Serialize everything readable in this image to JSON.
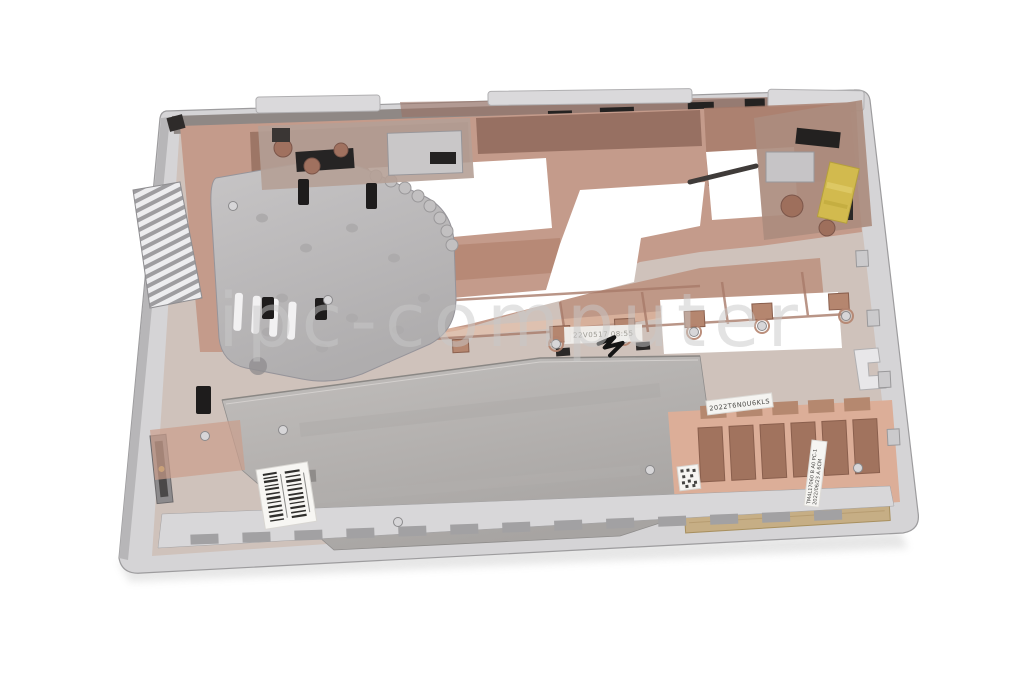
{
  "photo": {
    "subject": "Laptop bottom case (base enclosure), inside view, product photo on white background",
    "background": "#ffffff"
  },
  "watermark": {
    "text": "ipc-computer",
    "color": "#c9c9c9"
  },
  "markings": {
    "qc_stamp": "22V0517 08:55",
    "serial_sticker": "2022T6N0U6KLS",
    "date_label_line1": "TM4L17060 B A0 PC-1",
    "date_label_line2": "2022/06/23 A 6CM"
  },
  "colors": {
    "rim_silver": "#d5d4d6",
    "copper_coating": "#c49b8b",
    "copper_dark": "#8b655a",
    "shield_plate": "#b3b0ae",
    "fan_plate": "#c0bebf",
    "gold_pad": "#c6ae85",
    "kapton_tape": "#d2ba4e",
    "label_white": "#f7f6f3"
  }
}
